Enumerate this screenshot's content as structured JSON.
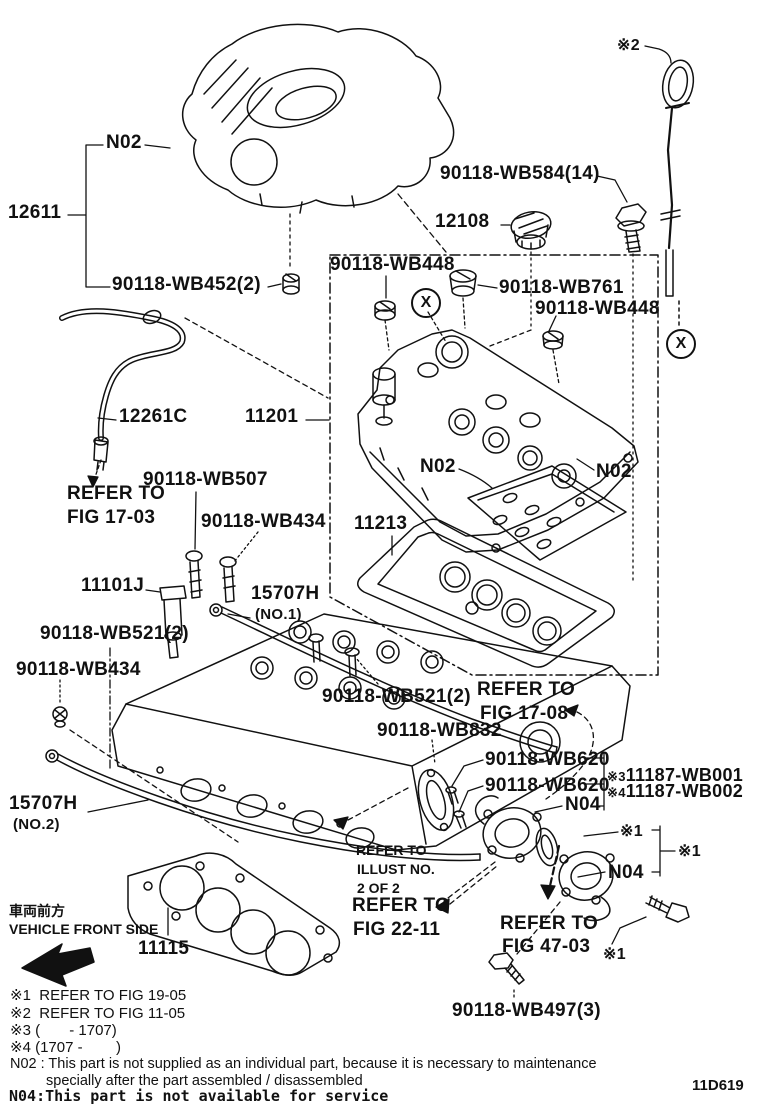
{
  "doc": {
    "drawing_code": "11D619",
    "x_symbol": "X"
  },
  "callouts": {
    "cover_n02": "N02",
    "cover_assy": "12611",
    "grommet_wb452": "90118-WB452(2)",
    "bolt_wb584": "90118-WB584(14)",
    "oil_cap": "12108",
    "seal_wb448_a": "90118-WB448",
    "grommet_wb761": "90118-WB761",
    "seal_wb448_b": "90118-WB448",
    "ref2_mark": "※2",
    "hose": "12261C",
    "valve_cover": "11201",
    "bolt_wb507": "90118-WB507",
    "bolt_wb434_a": "90118-WB434",
    "ocv": "11101J",
    "pipe1": "15707H",
    "pipe1_no": "(NO.1)",
    "bolt_wb521_a": "90118-WB521(2)",
    "bolt_wb434_b": "90118-WB434",
    "pipe2": "15707H",
    "pipe2_no": "(NO.2)",
    "baffle_n02_left": "N02",
    "baffle_n02_right": "N02",
    "vc_gasket": "11213",
    "bolt_wb521_b": "90118-WB521(2)",
    "plate_wb832": "90118-WB832",
    "stud_wb620_a": "90118-WB620",
    "stud_wb620_b": "90118-WB620",
    "head_opt3_mark": "※3",
    "head_opt3": "11187-WB001",
    "head_opt4_mark": "※4",
    "head_opt4": "11187-WB002",
    "inlet_n04": "N04",
    "ref1_mark_a": "※1",
    "ref1_mark_b": "※1",
    "outlet_n04": "N04",
    "ref1_mark_c": "※1",
    "bolt_wb497": "90118-WB497(3)",
    "head_gasket": "11115"
  },
  "refs": {
    "fig1703": [
      "REFER TO",
      "FIG 17-03"
    ],
    "fig1708": [
      "REFER TO",
      "FIG 17-08"
    ],
    "illust": [
      "REFER TO",
      "ILLUST NO.",
      "2 OF 2"
    ],
    "fig2211": [
      "REFER TO",
      "FIG 22-11"
    ],
    "fig4703": [
      "REFER TO",
      "FIG 47-03"
    ]
  },
  "notes": {
    "front_jp": "車両前方",
    "front_en": "VEHICLE FRONT SIDE",
    "fn1": "※1  REFER TO FIG 19-05",
    "fn2": "※2  REFER TO FIG 11-05",
    "fn3": "※3 (       - 1707)",
    "fn4": "※4 (1707 -        )",
    "n02_line1": "N02 : This part is not supplied as an individual part, because it is necessary to maintenance",
    "n02_line2": "specially after the part assembled / disassembled",
    "n04_line": "N04:This part is not available for service"
  }
}
